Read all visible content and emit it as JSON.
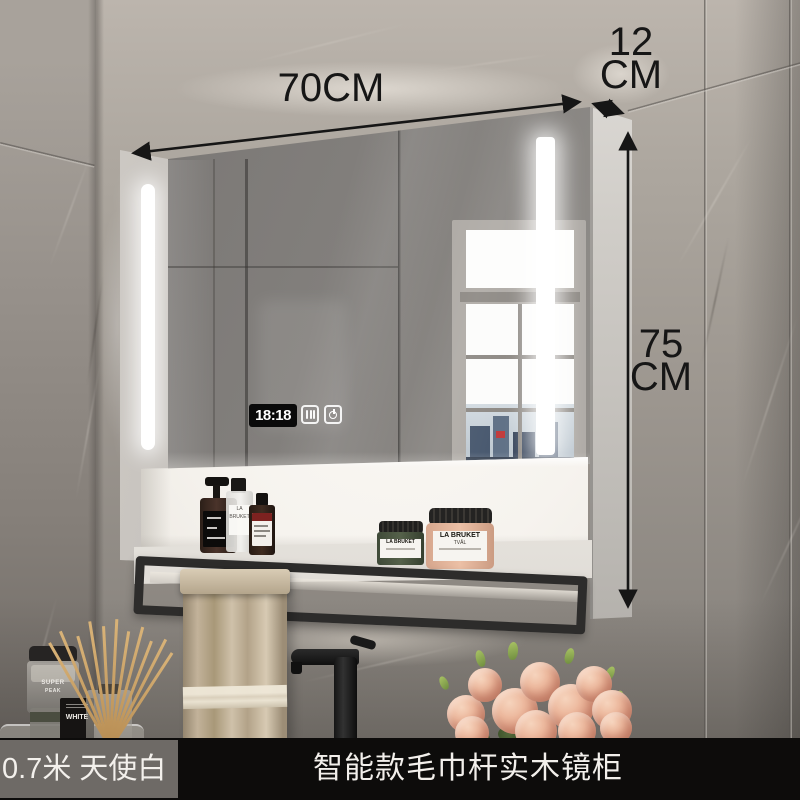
{
  "annotations": {
    "width": "70CM",
    "depth": [
      "12",
      "CM"
    ],
    "height": [
      "75",
      "CM"
    ],
    "color": "#161616"
  },
  "smart_panel": {
    "clock": "18:18",
    "icons": [
      "defog-icon",
      "power-icon"
    ]
  },
  "shelf_products": {
    "spray_bottle_label": "LA BRUKET",
    "jar_green_brand": "LA BRUKET",
    "jar_pink_brand": "LA BRUKET",
    "jar_pink_sub": "TVÅL"
  },
  "counter_products": {
    "jar_line1": "SUPER",
    "jar_line2": "PEAK",
    "box_label": "WHITE"
  },
  "footer": {
    "variant": "0.7米 天使白",
    "title": "智能款毛巾杆实木镜柜"
  },
  "colors": {
    "footer_bg": "#0d0c0b",
    "footer_variant_bg": "#6e6a66",
    "footer_text": "#f2efeb",
    "led": "#ffffff",
    "towel": "#c2b29a",
    "flower": "#e8ab91",
    "towel_bar": "#2d2c2b"
  }
}
